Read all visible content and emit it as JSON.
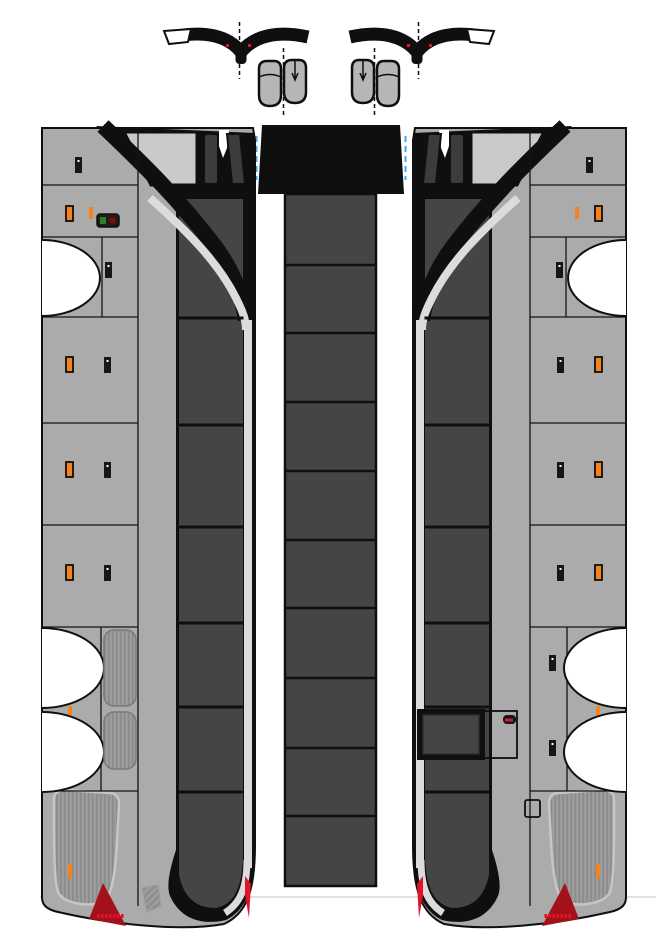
{
  "document": {
    "title": "Coach bus papercraft cut-out template sheet",
    "description": "Unfolded paper model parts: left body side, segmented roof strip, right body side with passenger door, and two rear-view mirror assemblies with fold lines",
    "background": "#ffffff"
  },
  "colors": {
    "black": "#0f0f0f",
    "body": "#ababab",
    "glass": "#c9c9c9",
    "window": "#454545",
    "window_dark": "#3c3c3c",
    "silver": "#dcdcdc",
    "grille": "#9c9c9c",
    "grille_line": "#8b8b8b",
    "grille_outline": "#c6c6c6",
    "orange": "#f5821f",
    "red_bright": "#e01425",
    "red_dark": "#a3111b",
    "green": "#2a7f2a",
    "blue_guide": "#3fa8ec",
    "faint_line": "#cfcfcf",
    "mirror_fill": "#b6b6b6",
    "panel_line": "#141414",
    "pill_dark": "#1c1c1c"
  },
  "inventory": {
    "roof_segments": 10,
    "side_window_panes_per_side": 7,
    "wheel_arches_per_side": 3,
    "mirror_assemblies": 2,
    "passenger_door_side": "right",
    "tail_lights": 2,
    "side_grilles_left": 2,
    "rear_engine_grilles": 2
  },
  "geometry": {
    "roof": {
      "x": 285,
      "width": 91,
      "top": 194,
      "bottom": 886,
      "dividers": [
        265,
        333,
        402,
        471,
        540,
        608,
        678,
        748,
        816
      ]
    },
    "band": {
      "x1": 179,
      "x2": 243.5,
      "dividers": [
        318,
        425,
        527,
        623,
        707,
        792
      ]
    },
    "panel_lines": {
      "x1": 42,
      "x2": 138,
      "ys": [
        185,
        237,
        317,
        423,
        525,
        627,
        791
      ]
    },
    "v_lines": [
      {
        "x": 138,
        "y1": 128,
        "y2": 906
      },
      {
        "x": 102,
        "y1": 237,
        "y2": 317
      },
      {
        "x": 101,
        "y1": 627,
        "y2": 791
      }
    ],
    "arches": [
      {
        "y1": 240,
        "y2": 316,
        "rx": 58
      },
      {
        "y1": 628,
        "y2": 708,
        "rx": 62
      },
      {
        "y1": 712,
        "y2": 792,
        "rx": 62
      }
    ],
    "handles": [
      {
        "x": 75,
        "y": 157
      },
      {
        "x": 105,
        "y": 262
      },
      {
        "x": 104,
        "y": 357
      },
      {
        "x": 104,
        "y": 462
      },
      {
        "x": 104,
        "y": 565
      }
    ],
    "orange_latches": [
      {
        "x": 66,
        "y": 206
      },
      {
        "x": 66,
        "y": 357
      },
      {
        "x": 66,
        "y": 462
      },
      {
        "x": 66,
        "y": 565
      }
    ],
    "orange_ticks": [
      {
        "x": 89,
        "y": 207,
        "h": 12
      },
      {
        "x": 68,
        "y": 706,
        "h": 9
      },
      {
        "x": 68,
        "y": 864,
        "h": 14
      }
    ],
    "tail_dots": {
      "y": 914,
      "x0": 97,
      "step": 4,
      "count": 7
    },
    "right_handles": [
      {
        "x": 112,
        "y": 655
      },
      {
        "x": 112,
        "y": 740
      }
    ]
  }
}
